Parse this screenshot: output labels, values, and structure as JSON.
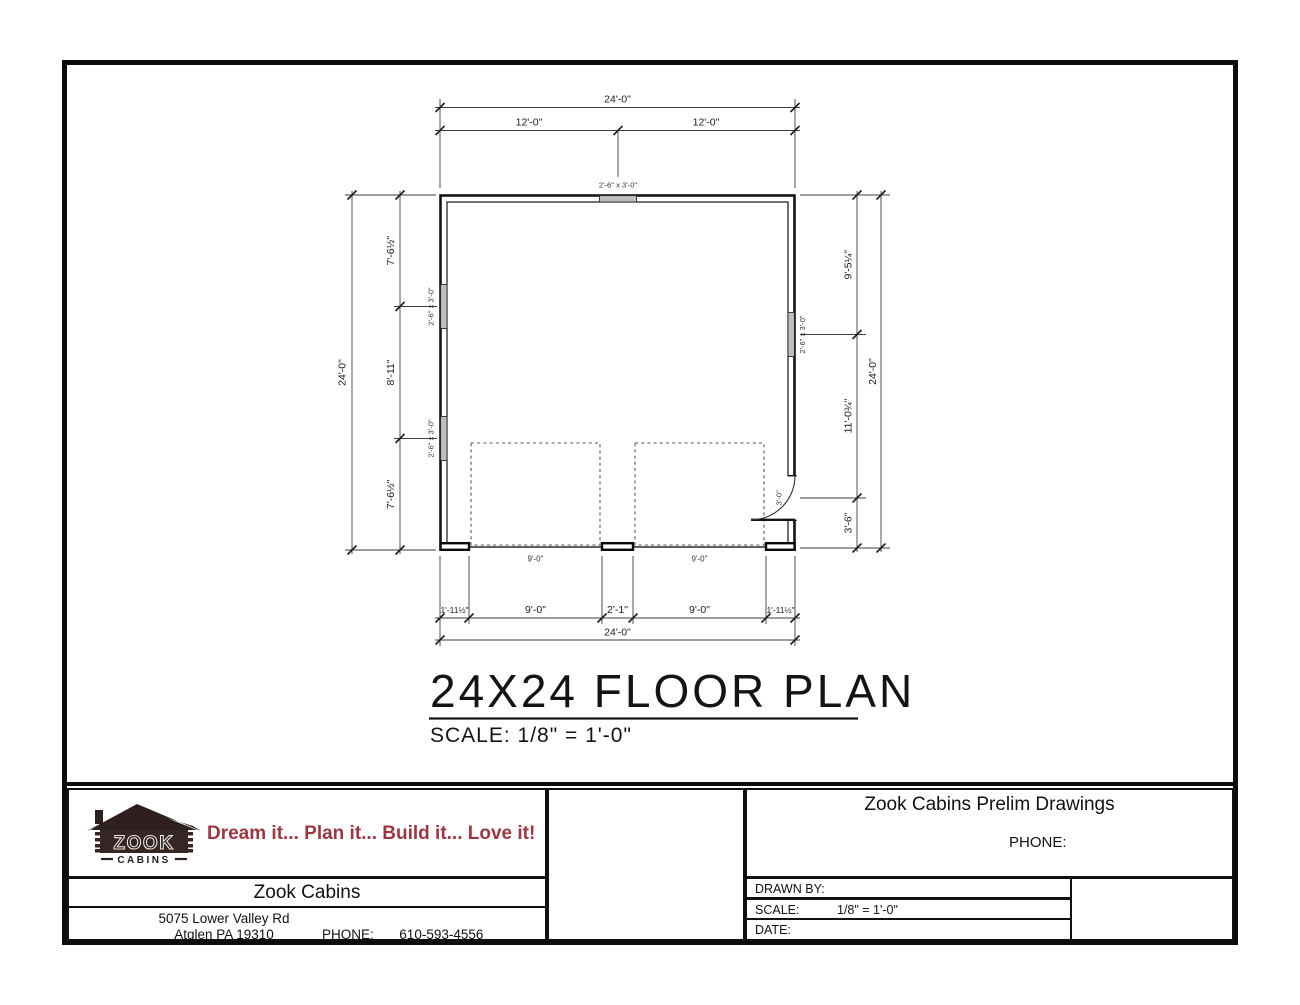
{
  "plan": {
    "title": "24X24 FLOOR PLAN",
    "scale_note": "SCALE: 1/8\" = 1'-0\"",
    "window_label": "2'-6\" x 3'-0\"",
    "door_label": "3'-0\"",
    "dims": {
      "overall": "24'-0\"",
      "top_half_left": "12'-0\"",
      "top_half_right": "12'-0\"",
      "left_top": "7'-6½\"",
      "left_mid": "8'-11\"",
      "left_bottom": "7'-6½\"",
      "right_top": "9'-5¼\"",
      "right_mid": "11'-0¾\"",
      "right_bottom": "3'-6\"",
      "bottom_pier_left": "1'-11½\"",
      "bottom_opening_left": "9'-0\"",
      "bottom_center_pier": "2'-1\"",
      "bottom_opening_right": "9'-0\"",
      "bottom_pier_right": "1'-11½\"",
      "garage_left_label": "9'-0\"",
      "garage_right_label": "9'-0\""
    }
  },
  "title_block": {
    "logo": {
      "name": "ZOOK",
      "sub": "CABINS"
    },
    "tagline": "Dream it... Plan it... Build it... Love it!",
    "company": {
      "name": "Zook Cabins",
      "address_line1": "5075 Lower Valley Rd",
      "address_line2": "Atglen PA 19310",
      "phone_label": "PHONE:",
      "phone": "610-593-4556"
    },
    "project": {
      "title": "Zook Cabins Prelim Drawings",
      "phone_label": "PHONE:",
      "drawn_by_label": "DRAWN BY:",
      "scale_label": "SCALE:",
      "scale_value": "1/8\" = 1'-0\"",
      "date_label": "DATE:"
    }
  },
  "colors": {
    "line": "#111111",
    "accent_red": "#9c3742",
    "logo_dark": "#342424"
  }
}
